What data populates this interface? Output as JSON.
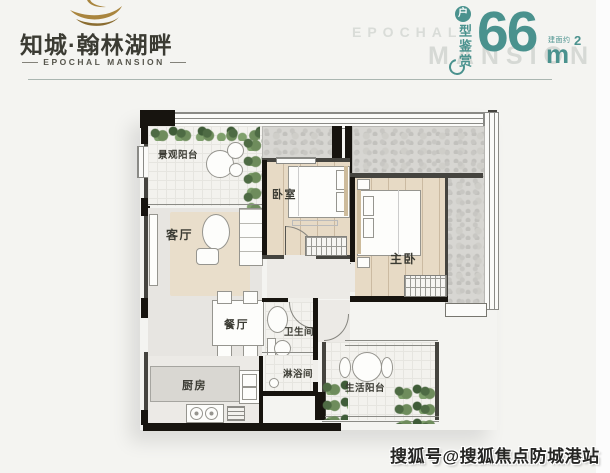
{
  "brand": {
    "name": "知城·翰林湖畔",
    "name_en": "EPOCHAL MANSION",
    "colors": {
      "gold": "#a9853e",
      "ink": "#3b3b33"
    }
  },
  "badge": {
    "circle_char": "户",
    "vertical_text": "型鉴赏",
    "area_value": "66",
    "area_prefix": "建面约",
    "unit": "m",
    "unit_sup": "2",
    "color": "#4a928e"
  },
  "bg_watermark": {
    "line1": "EPOCHAL",
    "line2": "MANSION"
  },
  "credit_watermark": "搜狐号@搜狐焦点防城港站",
  "floorplan": {
    "rooms": [
      {
        "id": "view-balcony",
        "label": "景观阳台"
      },
      {
        "id": "living-room",
        "label": "客厅"
      },
      {
        "id": "bedroom",
        "label": "卧室"
      },
      {
        "id": "master-bedroom",
        "label": "主卧"
      },
      {
        "id": "dining-room",
        "label": "餐厅"
      },
      {
        "id": "bathroom",
        "label": "卫生间"
      },
      {
        "id": "shower-room",
        "label": "淋浴间"
      },
      {
        "id": "kitchen",
        "label": "厨房"
      },
      {
        "id": "utility-balcony",
        "label": "生活阳台"
      }
    ]
  }
}
